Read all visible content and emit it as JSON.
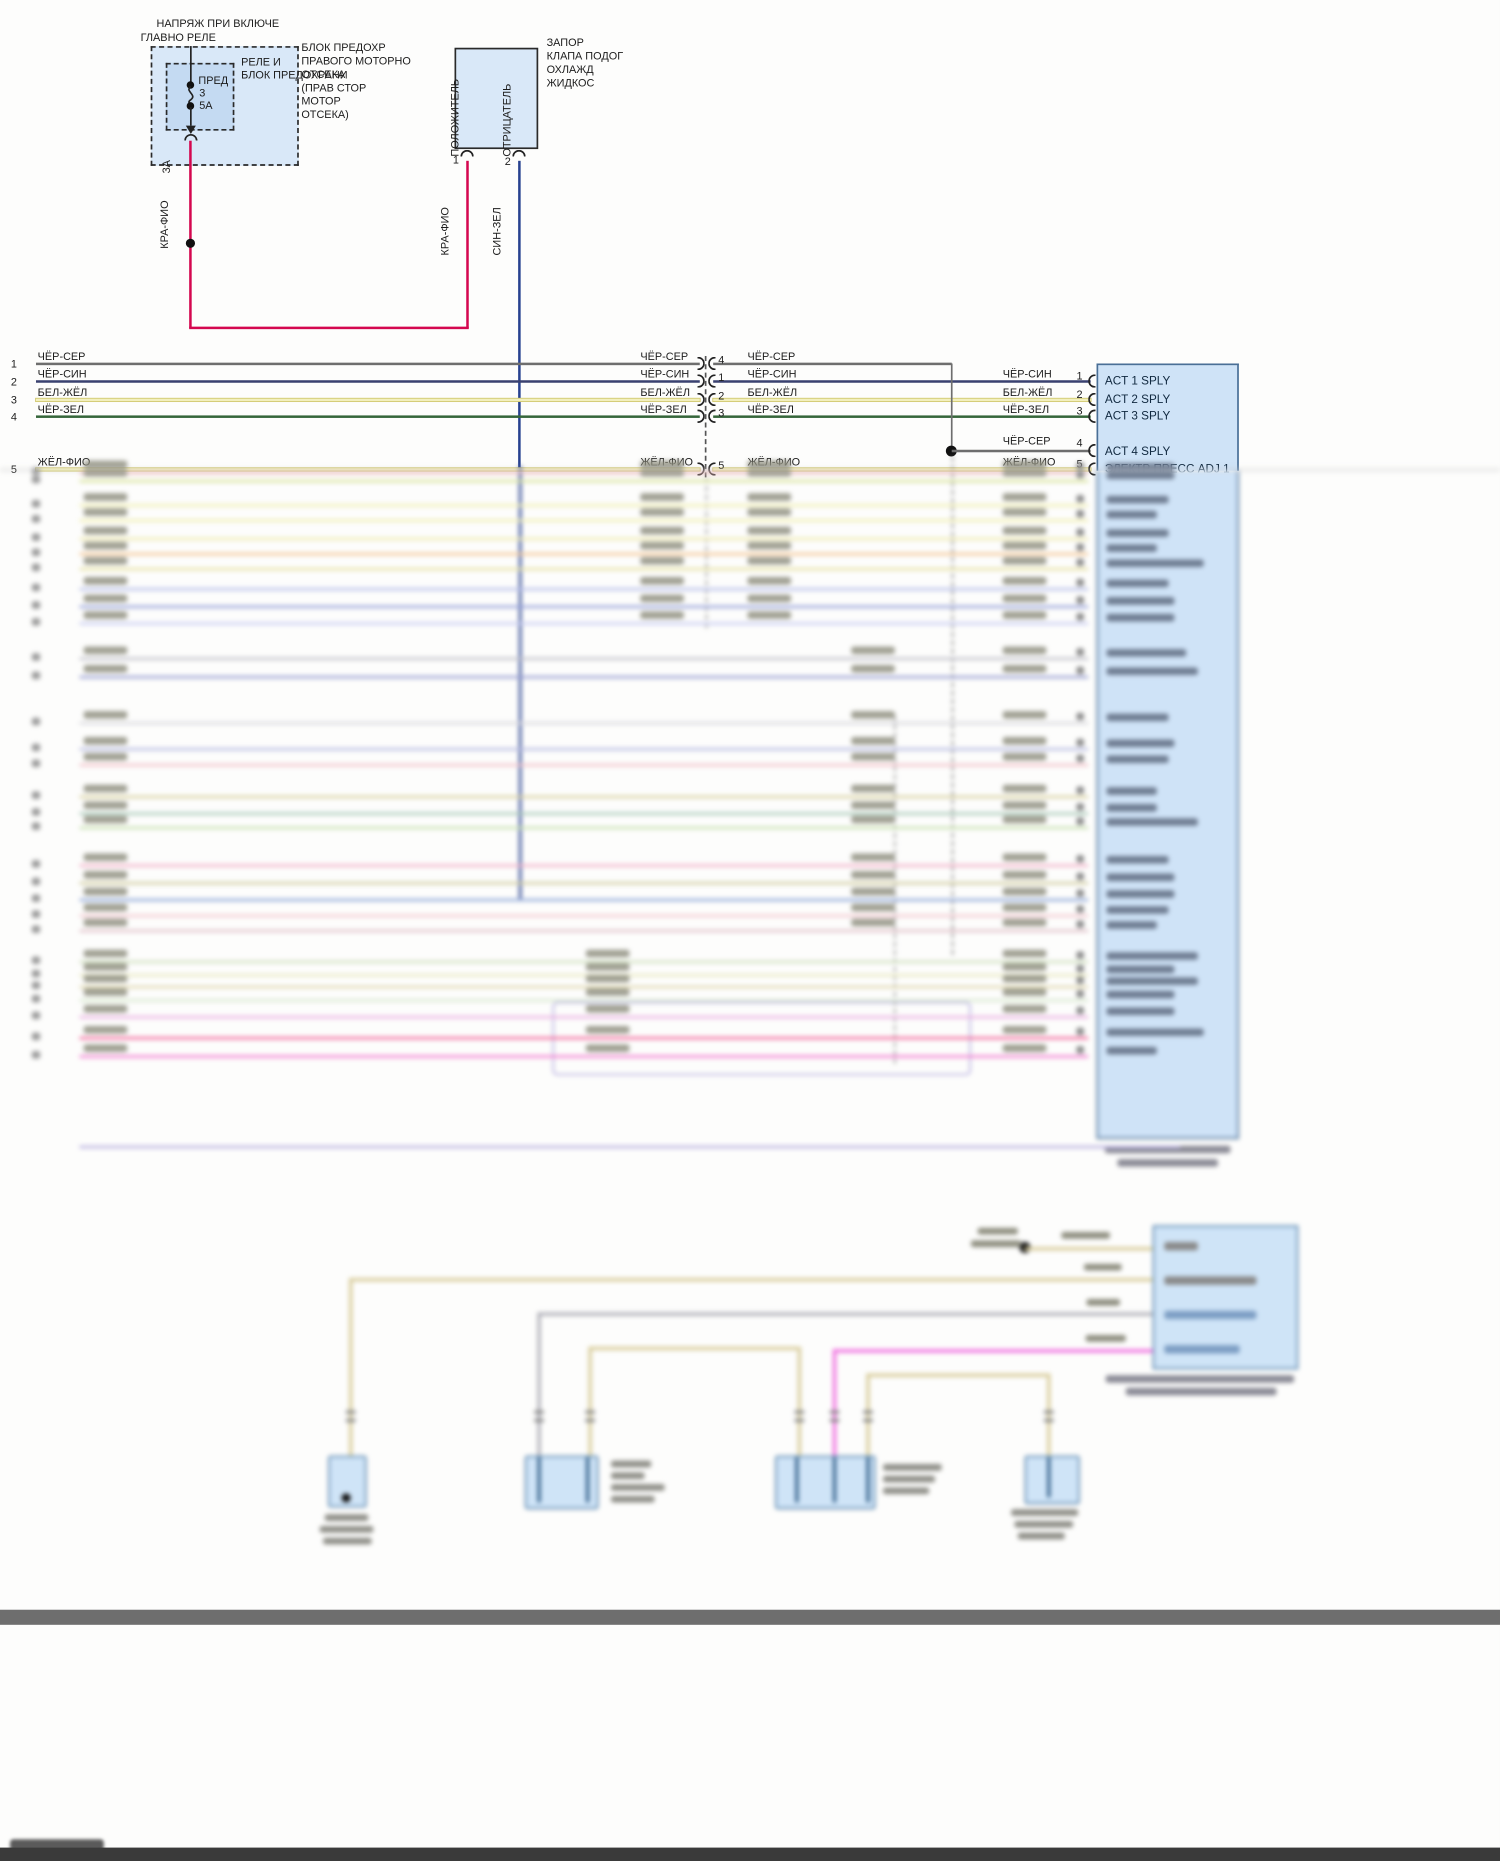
{
  "colors": {
    "red_wire": "#d4074f",
    "blue_wire": "#27418f",
    "gray_wire": "#6e6e6e",
    "navy_wire": "#3a4170",
    "paleyellow_wire": "#f2efbe",
    "paleyellow_edge": "#cfc66a",
    "green_wire": "#35663a",
    "box_fill": "#d9e8f8",
    "box_fill_inner": "#c4daf2",
    "block_fill": "#cfe3f7",
    "block_border": "#4a6f96",
    "comp_fill": "#cfe4f7",
    "comp_border": "#5b86ad",
    "tan_wire": "#d8cc9a",
    "gray2_wire": "#b0b0b8",
    "magenta_wire": "#f06ee0",
    "lavender": "#b8b0e0",
    "bar_gray": "#6e6e6e",
    "frame_dark": "#3a3a3a"
  },
  "top": {
    "header_line1": "НАПРЯЖ ПРИ ВКЛЮЧЕ",
    "header_line2": "ГЛАВНО РЕЛЕ",
    "fusebox_label1": "РЕЛЕ И",
    "fusebox_label2": "БЛОК ПРЕДОХРАНИ",
    "fusebox_right_lines": [
      "БЛОК ПРЕДОХР",
      "ПРАВОГО МОТОРНО",
      "ОТСЕКА",
      "(ПРАВ СТОР",
      "МОТОР",
      "ОТСЕКА)"
    ],
    "fuse_name": "ПРЕД",
    "fuse_num": "3",
    "fuse_rating": "5А",
    "fuse_pin": "3А",
    "wire_label_left": "КРА-ФИО",
    "solenoid_pin1_wire": "КРА-ФИО",
    "solenoid_pin2_wire": "СИН-ЗЕЛ",
    "solenoid_pos": "ПОЛОЖИТЕЛЬ",
    "solenoid_neg": "ОТРИЦАТЕЛЬ",
    "solenoid_pin1": "1",
    "solenoid_pin2": "2",
    "solenoid_title": [
      "ЗАПОР",
      "КЛАПА ПОДОГ",
      "ОХЛАЖД",
      "ЖИДКОС"
    ]
  },
  "bus": {
    "rows": [
      {
        "num": "1",
        "label": "ЧЁР-СЕР",
        "conn_pin": "4",
        "block_pin": "4",
        "y": 434,
        "color": "gray"
      },
      {
        "num": "2",
        "label": "ЧЁР-СИН",
        "conn_pin": "1",
        "block_pin": "1",
        "y": 455,
        "color": "navy"
      },
      {
        "num": "3",
        "label": "БЕЛ-ЖЁЛ",
        "conn_pin": "2",
        "block_pin": "2",
        "y": 477,
        "color": "paleyellow"
      },
      {
        "num": "4",
        "label": "ЧЁР-ЗЕЛ",
        "conn_pin": "3",
        "block_pin": "3",
        "y": 497,
        "color": "green"
      },
      {
        "num": "5",
        "label": "ЖЁЛ-ФИО",
        "conn_pin": "5",
        "block_pin": "5",
        "y": 560,
        "color": "paleyellow"
      }
    ]
  },
  "block": {
    "pins": [
      {
        "text": "ACT 1 SPLY",
        "y": 453
      },
      {
        "text": "ACT 2 SPLY",
        "y": 475
      },
      {
        "text": "ACT 3 SPLY",
        "y": 495
      },
      {
        "text": "ACT 4 SPLY",
        "y": 537
      },
      {
        "text": "ЭЛЕКТР ПРЕСС ADJ 1",
        "y": 558
      }
    ],
    "branch_label": "ЧЁР-СЕР",
    "branch_pin": "4",
    "row5_label": "ЖЁЛ-ФИО",
    "row5_pin": "5"
  },
  "blur": {
    "rows": [
      {
        "y": 563,
        "c": "#efb6b6",
        "cols": [
          100,
          765,
          893,
          1198
        ]
      },
      {
        "y": 573,
        "c": "#d9e39c",
        "cols": [
          100,
          765,
          893,
          1198
        ]
      },
      {
        "y": 602,
        "c": "#f1efb4",
        "cols": [
          100,
          765,
          893,
          1198
        ]
      },
      {
        "y": 620,
        "c": "#f1efb4",
        "cols": [
          100,
          765,
          893,
          1198
        ]
      },
      {
        "y": 642,
        "c": "#efeab2",
        "cols": [
          100,
          765,
          893,
          1198
        ]
      },
      {
        "y": 660,
        "c": "#f5c897",
        "cols": [
          100,
          765,
          893,
          1198
        ]
      },
      {
        "y": 678,
        "c": "#e7e2a6",
        "cols": [
          100,
          765,
          893,
          1198
        ]
      },
      {
        "y": 702,
        "c": "#b9c1ea",
        "cols": [
          100,
          765,
          893,
          1198
        ]
      },
      {
        "y": 723,
        "c": "#98a3da",
        "cols": [
          100,
          765,
          893,
          1198
        ]
      },
      {
        "y": 743,
        "c": "#c9cdf2",
        "cols": [
          100,
          765,
          893,
          1198
        ]
      },
      {
        "y": 785,
        "c": "#c2c2cb",
        "cols": [
          100,
          1017,
          1198
        ]
      },
      {
        "y": 807,
        "c": "#9aa0d2",
        "cols": [
          100,
          1017,
          1198
        ]
      },
      {
        "y": 862,
        "c": "#d9d9de",
        "cols": [
          100,
          1017,
          1198
        ]
      },
      {
        "y": 893,
        "c": "#b9bde2",
        "cols": [
          100,
          1017,
          1198
        ]
      },
      {
        "y": 912,
        "c": "#f2c2ca",
        "cols": [
          100,
          1017,
          1198
        ]
      },
      {
        "y": 950,
        "c": "#d9d1a2",
        "cols": [
          100,
          1017,
          1198
        ]
      },
      {
        "y": 970,
        "c": "#a9c9b9",
        "cols": [
          100,
          1017,
          1198
        ]
      },
      {
        "y": 987,
        "c": "#c9e1b2",
        "cols": [
          100,
          1017,
          1198
        ]
      },
      {
        "y": 1032,
        "c": "#f2b2ca",
        "cols": [
          100,
          1017,
          1198
        ]
      },
      {
        "y": 1053,
        "c": "#d1cda2",
        "cols": [
          100,
          1017,
          1198
        ]
      },
      {
        "y": 1073,
        "c": "#92aada",
        "cols": [
          100,
          1017,
          1198
        ]
      },
      {
        "y": 1092,
        "c": "#f2c9d1",
        "cols": [
          100,
          1017,
          1198
        ]
      },
      {
        "y": 1110,
        "c": "#e1c2ca",
        "cols": [
          100,
          1017,
          1198
        ]
      },
      {
        "y": 1147,
        "c": "#d1e1c2",
        "cols": [
          100,
          700,
          1198
        ]
      },
      {
        "y": 1163,
        "c": "#e9e9c2",
        "cols": [
          100,
          700,
          1198
        ]
      },
      {
        "y": 1177,
        "c": "#e1d9b2",
        "cols": [
          100,
          700,
          1198
        ]
      },
      {
        "y": 1193,
        "c": "#d9e9d1",
        "cols": [
          100,
          700,
          1198
        ]
      },
      {
        "y": 1213,
        "c": "#eab2e2",
        "cols": [
          100,
          700,
          1198
        ]
      },
      {
        "y": 1238,
        "c": "#f26b9e",
        "cols": [
          100,
          700,
          1198
        ]
      },
      {
        "y": 1260,
        "c": "#f282d2",
        "cols": [
          100,
          700,
          1198
        ]
      }
    ],
    "row_x1": 95,
    "row_x2": 1300,
    "block_rect": {
      "x": 1310,
      "y": 434,
      "w": 170,
      "h": 926
    },
    "block_caption": [
      {
        "x": 1320,
        "y": 1368,
        "w": 150
      },
      {
        "x": 1335,
        "y": 1384,
        "w": 120
      }
    ],
    "lavender_box": {
      "x": 660,
      "y": 1196,
      "w": 500,
      "h": 88
    },
    "lavender_line": {
      "y": 1368,
      "x1": 95,
      "x2": 1410
    },
    "verticals": [
      {
        "x": 620,
        "y1": 556,
        "y2": 1073,
        "c": "#27418f",
        "w": 3
      },
      {
        "x": 1137,
        "y1": 545,
        "y2": 1140,
        "c": "#8a8a8a",
        "w": 2,
        "dashed": true
      },
      {
        "x": 843,
        "y1": 560,
        "y2": 750,
        "c": "#9a9a9a",
        "w": 2,
        "dashed": true
      },
      {
        "x": 1068,
        "y1": 855,
        "y2": 1270,
        "c": "#9a9a9a",
        "w": 2,
        "dashed": true
      }
    ],
    "bottom": {
      "lower_block": {
        "x": 1377,
        "y": 1463,
        "w": 174,
        "h": 172
      },
      "lower_block_rows": [
        {
          "y": 1483,
          "c": "#8a8a8a",
          "w": 40
        },
        {
          "y": 1524,
          "c": "#8a8a8a",
          "w": 110
        },
        {
          "y": 1565,
          "c": "#7d9ec4",
          "w": 110
        },
        {
          "y": 1606,
          "c": "#7d9ec4",
          "w": 90
        }
      ],
      "lower_block_caption": [
        {
          "x": 1321,
          "y": 1642,
          "w": 225
        },
        {
          "x": 1345,
          "y": 1657,
          "w": 180
        }
      ],
      "dot": {
        "x": 1224,
        "y": 1489
      },
      "dot_labels": [
        {
          "x": 1168,
          "y": 1466,
          "w": 48
        },
        {
          "x": 1160,
          "y": 1481,
          "w": 60
        }
      ],
      "wireA": {
        "y": 1489,
        "x1": 1224,
        "x2": 1377,
        "c": "#d8cc9a",
        "label": {
          "x": 1268,
          "y": 1471,
          "w": 58
        }
      },
      "wireB": {
        "y": 1526,
        "x1": 417,
        "x2": 1377,
        "c": "#d8cc9a",
        "label": {
          "x": 1295,
          "y": 1509,
          "w": 45
        }
      },
      "wireC": {
        "y": 1567,
        "x1": 642,
        "x2": 1377,
        "c": "#b0b0b8",
        "label": {
          "x": 1298,
          "y": 1551,
          "w": 40
        }
      },
      "wireD_tan": {
        "y": 1608,
        "x1": 703,
        "x2": 953,
        "c": "#d8cc9a"
      },
      "wireD_mag": {
        "y": 1611,
        "x1": 995,
        "x2": 1377,
        "c": "#f06ee0",
        "label": {
          "x": 1297,
          "y": 1594,
          "w": 48
        }
      },
      "loop": {
        "y": 1640,
        "x1": 1035,
        "x2": 1251,
        "c": "#d8cc9a"
      },
      "drops": [
        {
          "x": 417,
          "y1": 1526,
          "y2": 1738,
          "c": "#d8cc9a"
        },
        {
          "x": 642,
          "y1": 1567,
          "y2": 1738,
          "c": "#b0b0b8"
        },
        {
          "x": 703,
          "y1": 1608,
          "y2": 1738,
          "c": "#d8cc9a"
        },
        {
          "x": 953,
          "y1": 1608,
          "y2": 1738,
          "c": "#d8cc9a"
        },
        {
          "x": 995,
          "y1": 1611,
          "y2": 1790,
          "c": "#f06ee0"
        },
        {
          "x": 1035,
          "y1": 1640,
          "y2": 1738,
          "c": "#d8cc9a"
        },
        {
          "x": 1251,
          "y1": 1640,
          "y2": 1738,
          "c": "#d8cc9a"
        }
      ],
      "drop_connector_y": 1684,
      "components": [
        {
          "x": 392,
          "y": 1738,
          "w": 46,
          "h": 62,
          "dot": {
            "x": 413,
            "y": 1788
          }
        },
        {
          "x": 627,
          "y": 1738,
          "w": 88,
          "h": 64,
          "bars": [
            642,
            700
          ]
        },
        {
          "x": 926,
          "y": 1738,
          "w": 120,
          "h": 64,
          "bars": [
            950,
            995,
            1035
          ]
        },
        {
          "x": 1224,
          "y": 1738,
          "w": 66,
          "h": 58,
          "bars": [
            1251
          ]
        }
      ],
      "captions": [
        [
          {
            "x": 388,
            "y": 1808,
            "w": 52
          },
          {
            "x": 382,
            "y": 1822,
            "w": 64
          },
          {
            "x": 386,
            "y": 1836,
            "w": 58
          }
        ],
        [
          {
            "x": 730,
            "y": 1744,
            "w": 48
          },
          {
            "x": 730,
            "y": 1758,
            "w": 40
          },
          {
            "x": 730,
            "y": 1772,
            "w": 64
          },
          {
            "x": 730,
            "y": 1786,
            "w": 52
          }
        ],
        [
          {
            "x": 1055,
            "y": 1748,
            "w": 70
          },
          {
            "x": 1055,
            "y": 1762,
            "w": 62
          },
          {
            "x": 1055,
            "y": 1776,
            "w": 55
          }
        ],
        [
          {
            "x": 1208,
            "y": 1802,
            "w": 80
          },
          {
            "x": 1212,
            "y": 1816,
            "w": 70
          },
          {
            "x": 1216,
            "y": 1830,
            "w": 56
          }
        ]
      ]
    },
    "bar": {
      "y": 1922,
      "h": 18
    },
    "watermark": {
      "x": 12,
      "y": 2196,
      "w": 112,
      "h": 14
    },
    "bottom_frame": {
      "y": 2206,
      "h": 16
    }
  }
}
